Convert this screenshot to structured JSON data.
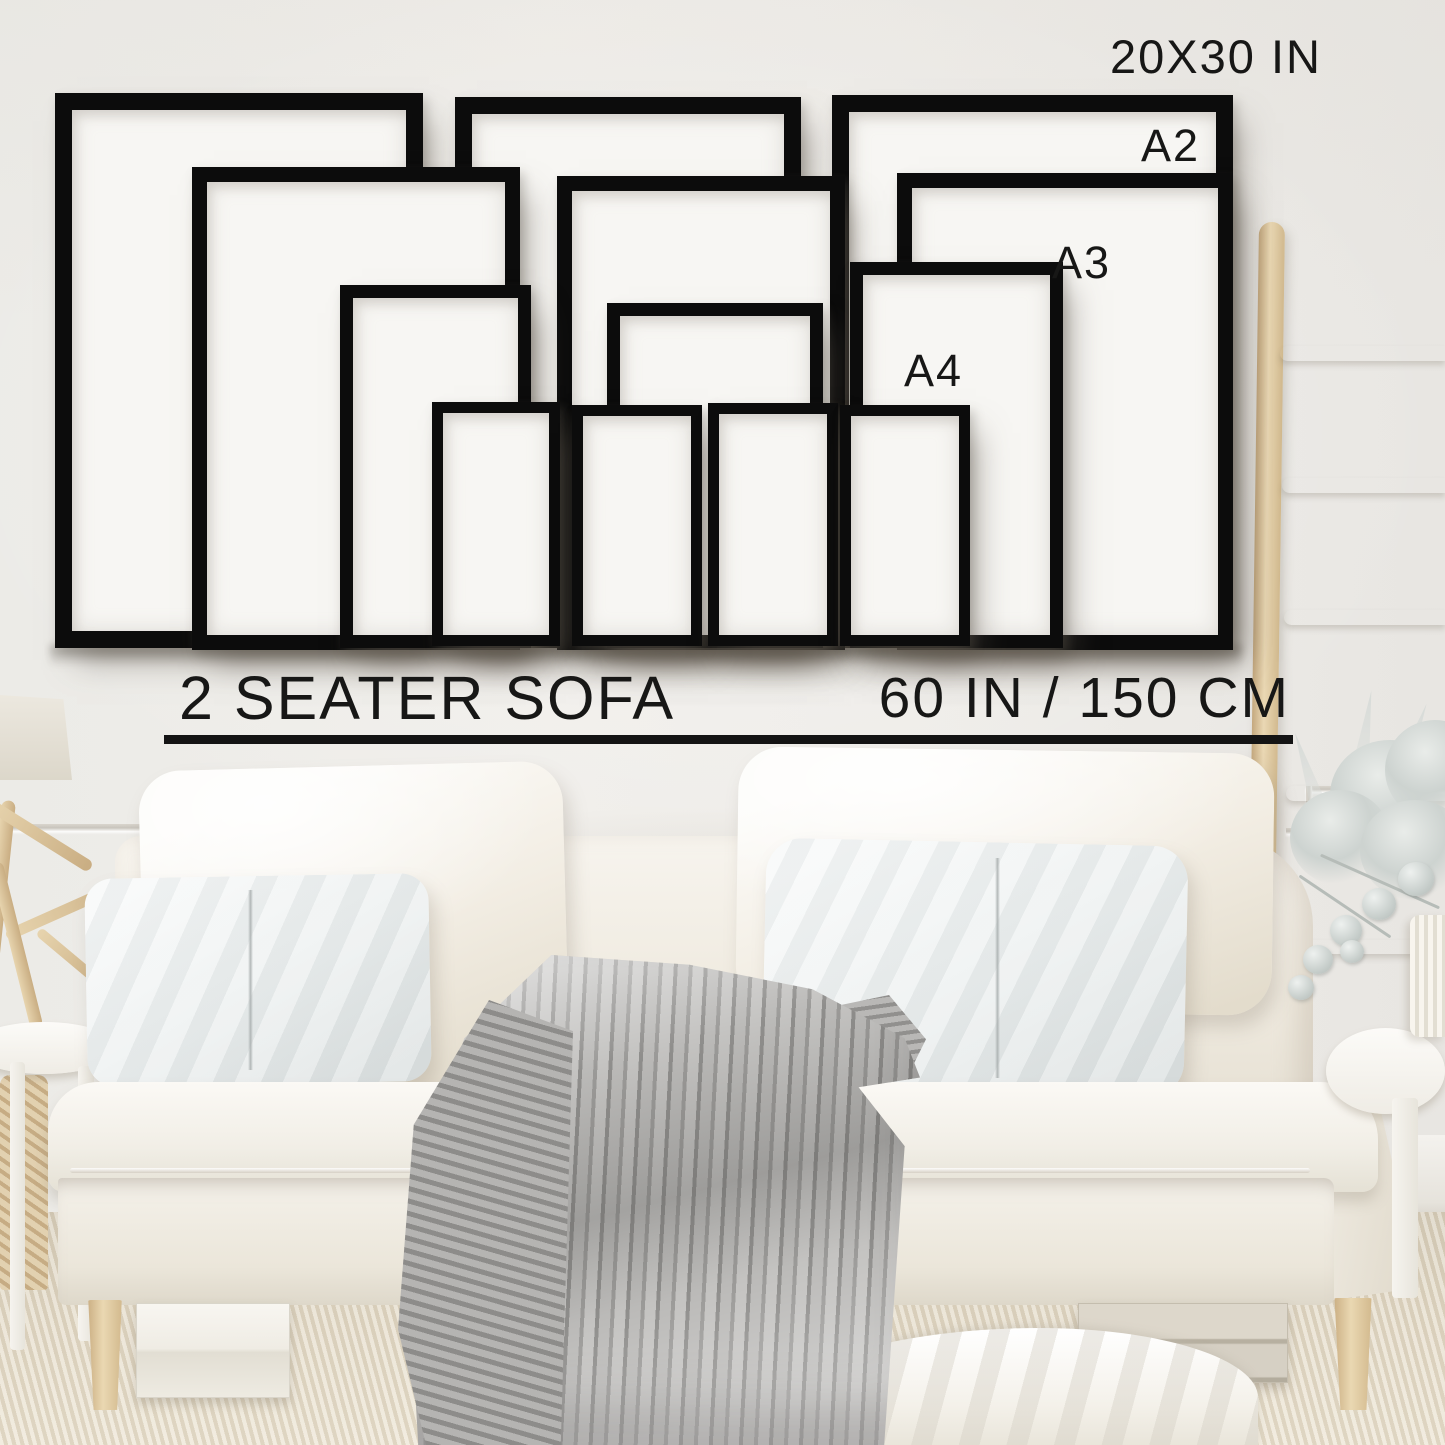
{
  "header": {
    "frame_size_title": "20X30 IN"
  },
  "frame_labels": {
    "a2": "A2",
    "a3": "A3",
    "a4": "A4"
  },
  "sofa_guide": {
    "sofa_label": "2 SEATER SOFA",
    "width_label": "60 IN / 150 CM"
  },
  "colors": {
    "frame_black": "#0c0c0c",
    "frame_matte_white": "#f7f6f3",
    "text": "#171716",
    "wall": "#eeece8",
    "wood_ladder": "#dcc49a",
    "sofa_cream": "#f2ede3",
    "pillow_cool_white": "#e9eded",
    "blanket_gray": "#a3a2a0",
    "carpet_beige": "#e0d7c4"
  }
}
